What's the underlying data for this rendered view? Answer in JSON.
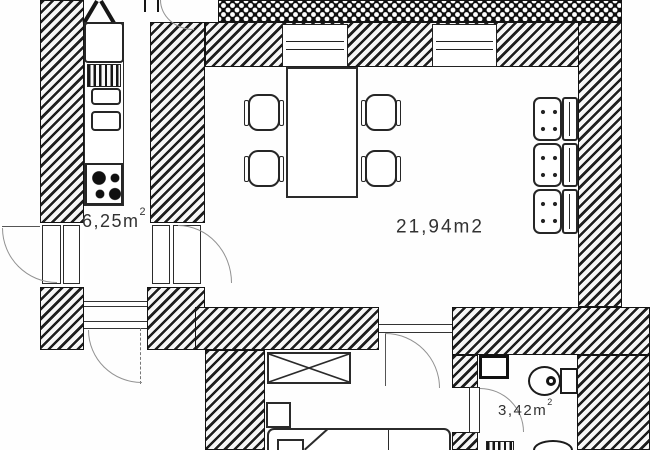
{
  "title": "apartment floor plan",
  "colors": {
    "ink": "#1d1d1d",
    "paper": "#ffffff",
    "door_arc": "#929292"
  },
  "rooms": {
    "kitchen": {
      "area_value": "6,25m",
      "area_exp": "2"
    },
    "living_room": {
      "area_value": "21,94m2",
      "area_exp": ""
    },
    "bathroom": {
      "area_value": "3,42m",
      "area_exp": "2"
    }
  },
  "fixtures": [
    "fridge",
    "vent-grille",
    "double-sink",
    "stove-4-burner",
    "dining-table",
    "chairs-x4",
    "sofa-3-seat",
    "wardrobe",
    "bed",
    "nightstand",
    "washbasin",
    "toilet",
    "shower-grille",
    "oval-sink"
  ]
}
